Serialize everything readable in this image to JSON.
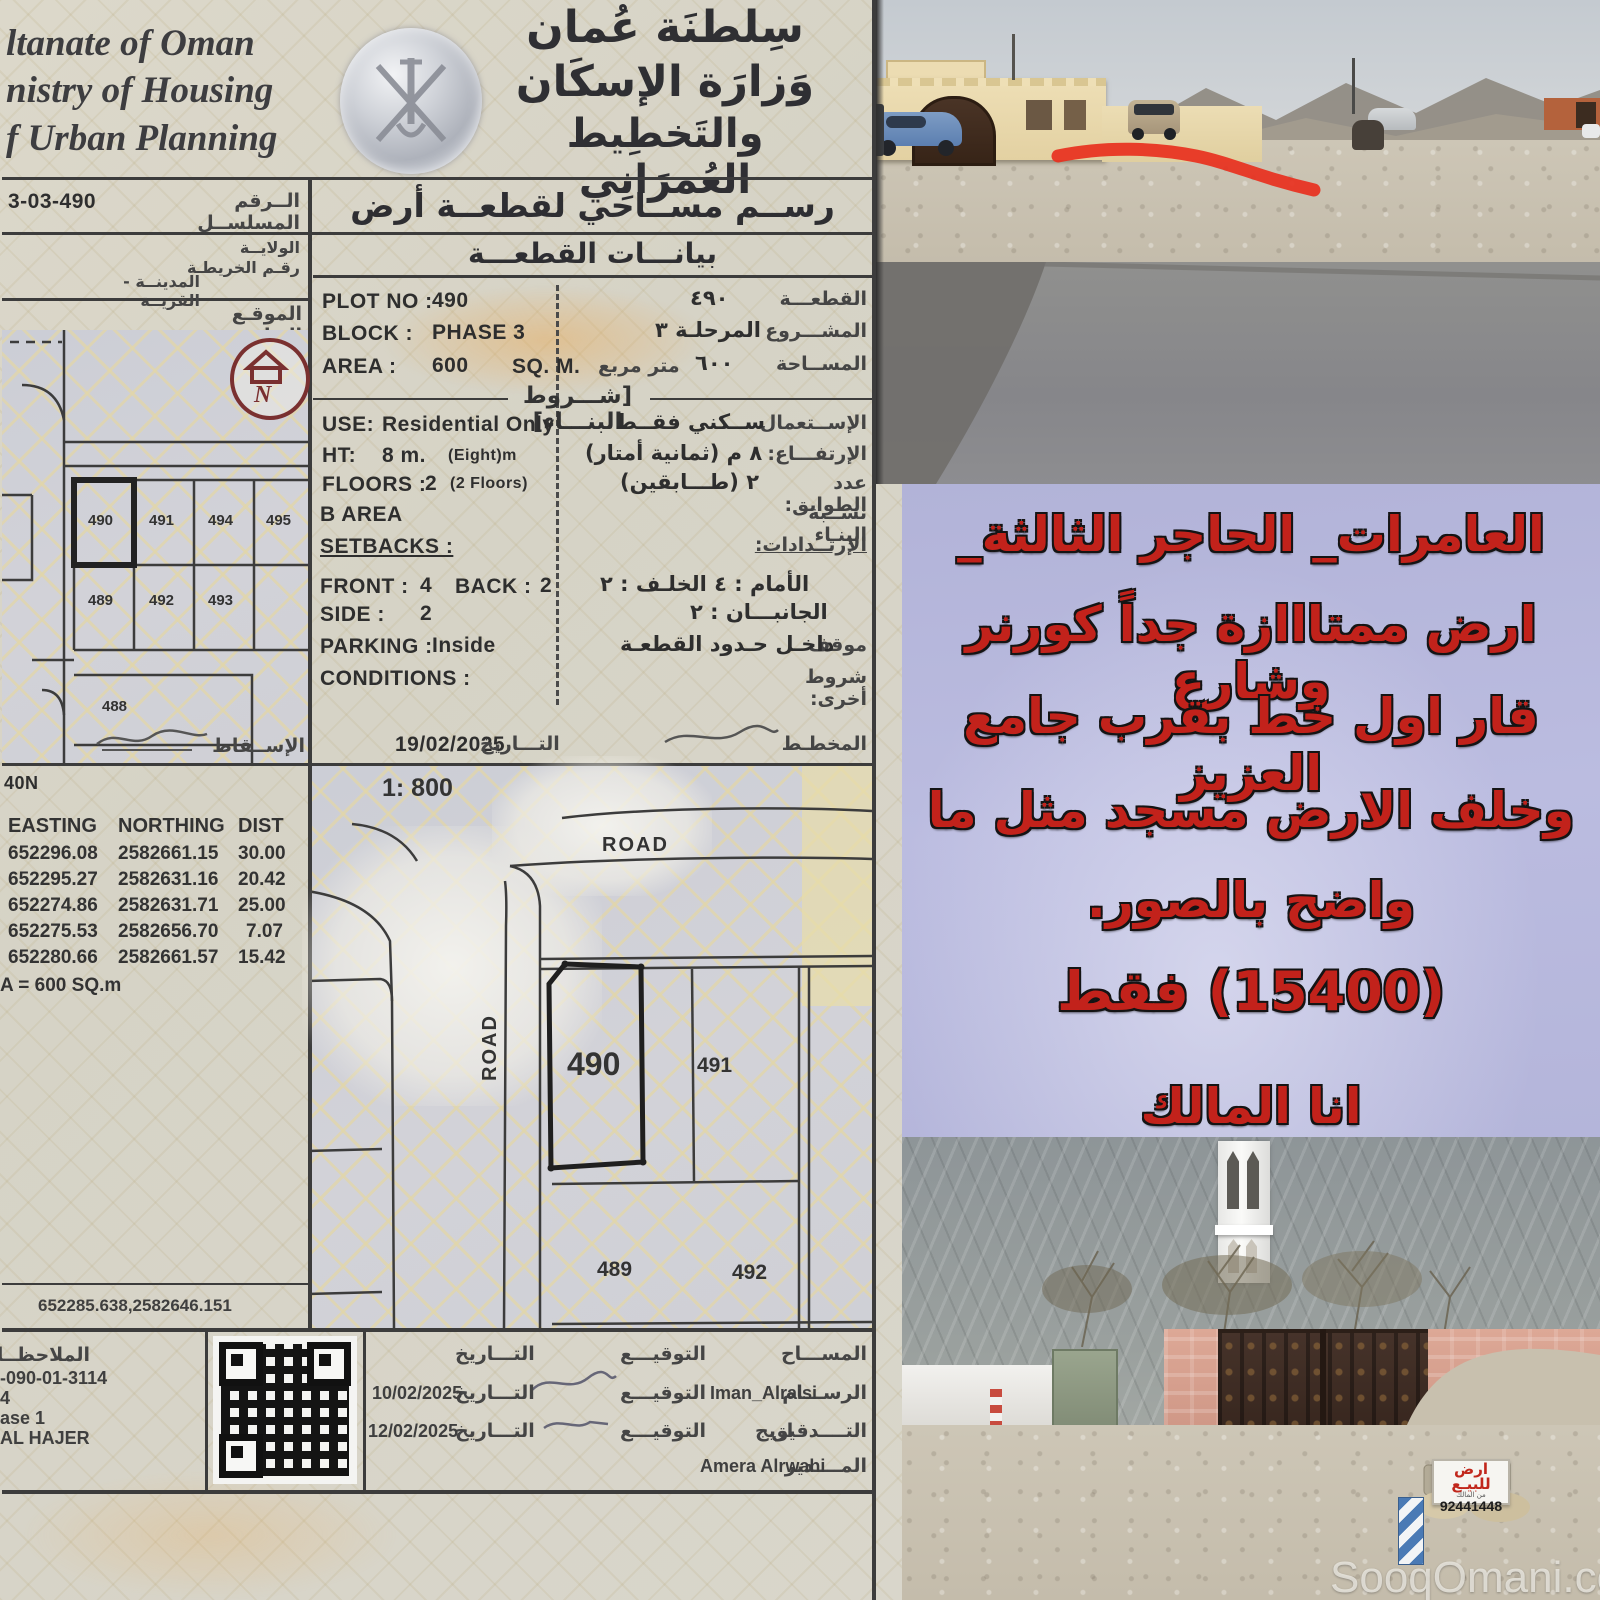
{
  "colors": {
    "paper": "#d8d4c6",
    "panel_purple": "#b6b7db",
    "ad_red": "#c2221b",
    "ink": "#3a3a3a",
    "sky": "#c7ccd1",
    "asphalt": "#8a8a8a",
    "gravel": "#cdc6b6",
    "villa_cream": "#e9d9ae",
    "gate_brown": "#46332a",
    "mosque_wall": "#d79e8e",
    "marker_red": "#e8301e",
    "minaret_white": "#f4f4f2"
  },
  "doc": {
    "header_en": {
      "line1": "ltanate of Oman",
      "line2": "nistry of Housing",
      "line3": "f Urban Planning"
    },
    "header_ar": {
      "line1": "سِلطنَة عُمان",
      "line2": "وَزارَة الإسكَان",
      "line3": "والتَخطِيط العُمرَانِي"
    },
    "serial": {
      "label": "الــرقم المسلســل",
      "value": "3-03-490"
    },
    "maprow": {
      "wilaya": "الولايــة",
      "map_no": "رقـم الخريطـة",
      "city": "المدينــة - القريــة"
    },
    "location_label": "الموقـع العـام",
    "title": "رســم مســاحي لقطعــة أرض",
    "subtitle": "بيانـــات القطعـــة",
    "plot": {
      "plot_en": "PLOT NO :",
      "plot_val": "490",
      "plot_ar_val": "٤٩٠",
      "plot_ar": "القطعـــة",
      "block_en": "BLOCK :",
      "block_val": "PHASE 3",
      "block_ar_val": "المرحلـة ٣",
      "block_ar": "المشـــروع",
      "area_en": "AREA :",
      "area_val": "600",
      "area_unit": "SQ. M.",
      "area_ar_val": "٦٠٠",
      "area_ar_unit": "متر مربع",
      "area_ar": "المســاحة"
    },
    "bc_title": "[شـــروط البنـــاء]",
    "cond": {
      "use_en": "USE:",
      "use_val": "Residential Only",
      "use_ar_val": "ســكني فقــط",
      "use_ar": "الإســتعمال",
      "ht_en": "HT:",
      "ht_val": "8 m.",
      "ht_val2": "(Eight)m",
      "ht_ar_val": "٨ م (ثمانية أمتار)",
      "ht_ar": "الإرتفـــاع:",
      "fl_en": "FLOORS :",
      "fl_val": "2",
      "fl_val2": "(2 Floors)",
      "fl_ar_val": "٢ (طـــابقين)",
      "fl_ar": "عدد الطوابق:",
      "ba_en": "B AREA",
      "ba_ar": "نســبة البنـاء",
      "sb_en": "SETBACKS :",
      "sb_ar": "الإرتــدادات:",
      "front_en": "FRONT :",
      "front_val": "4",
      "back_en": "BACK :",
      "back_val": "2",
      "front_ar": "الأمام : ٤    الخلـف : ٢",
      "side_en": "SIDE :",
      "side_val": "2",
      "side_ar": "الجانبـــان : ٢",
      "park_en": "PARKING :",
      "park_val": "Inside",
      "park_ar_val": "داخـل حـدود القطعـة",
      "park_ar": "موقف",
      "cnd_en": "CONDITIONS :",
      "cnd_ar": "شروط أخرى:"
    },
    "survey_date": {
      "value": "19/02/2025",
      "label": "التـــاريخ",
      "planner": "المخطـط"
    },
    "scale": "1: 800",
    "zone": "40N",
    "coords": {
      "h_e": "EASTING",
      "h_n": "NORTHING",
      "h_d": "DIST",
      "rows": [
        {
          "e": "652296.08",
          "n": "2582661.15",
          "d": "30.00"
        },
        {
          "e": "652295.27",
          "n": "2582631.16",
          "d": "20.42"
        },
        {
          "e": "652274.86",
          "n": "2582631.71",
          "d": "25.00"
        },
        {
          "e": "652275.53",
          "n": "2582656.70",
          "d": "7.07"
        },
        {
          "e": "652280.66",
          "n": "2582661.57",
          "d": "15.42"
        }
      ],
      "area_note": "A = 600  SQ.m"
    },
    "inset": {
      "p490": "490",
      "p491": "491",
      "p494": "494",
      "p495": "495",
      "p489": "489",
      "p492": "492",
      "p493": "493",
      "p488": "488",
      "north": "N",
      "projection": "الإســقاط"
    },
    "plan": {
      "road_top": "ROAD",
      "road_left": "ROAD",
      "p490": "490",
      "p491": "491",
      "p489": "489",
      "p492": "492",
      "ref": "652285.638,2582646.151"
    },
    "notes": {
      "title": "الملاحظــات",
      "line1": "-090-01-3114",
      "line2": "4",
      "line3": "ase 1",
      "line4": "AL HAJER"
    },
    "sig": {
      "r1": {
        "role": "المســـاح",
        "sig": "التوقيـــع",
        "dl": "التـــاريخ"
      },
      "r2": {
        "role": "الرســـام",
        "name": "Iman_Alraisi",
        "sig": "التوقيـــع",
        "dl": "التـــاريخ",
        "date": "10/02/2025"
      },
      "r3": {
        "role": "التــــدقيق",
        "name": "اريج",
        "sig": "التوقيـــع",
        "dl": "التـــاريخ",
        "date": "12/02/2025"
      },
      "r4": {
        "role": "المــــدير",
        "name": "Amera Alrwahi"
      }
    }
  },
  "ad": {
    "line1": "العامرات_ الحاجر الثالثة_",
    "line2": "ارض ممتااازة جداً كورنر وشارع",
    "line3": "قار اول خط بقرب جامع العزيز",
    "line4": "وخلف الارض مسجد مثل ما",
    "line5": "واضح بالصور.",
    "line6": "(15400) فقط",
    "line7": "انا المالك"
  },
  "sale_sign": {
    "title": "ارض للبيـع",
    "sub": "من المالك",
    "phone": "92441448"
  },
  "watermark": "SooqOmani.com"
}
